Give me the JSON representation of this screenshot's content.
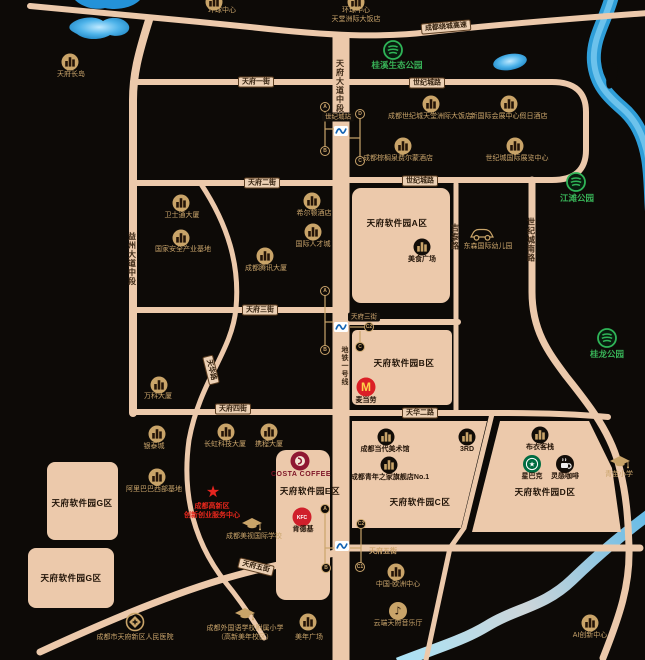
{
  "title": "天府软件园区域地图",
  "colors": {
    "background": "#0d0a07",
    "road": "#ecc9ab",
    "road_text": "#3a2715",
    "poi_text": "#c9a46b",
    "district_text": "#1f1206",
    "park_green": "#38b257",
    "alert_red": "#e6271c",
    "river_blue": "#2f9ed8",
    "metro_blue": "#1464b4",
    "mcdonalds_red": "#db1f26",
    "kfc_red": "#d01f2b",
    "costa_maroon": "#8f1732",
    "starbucks_green": "#006c41"
  },
  "districts": [
    {
      "name": "district-a",
      "label": "天府软件园A区",
      "x": 397,
      "y": 223
    },
    {
      "name": "district-b",
      "label": "天府软件园B区",
      "x": 404,
      "y": 363
    },
    {
      "name": "district-c",
      "label": "天府软件园C区",
      "x": 420,
      "y": 502
    },
    {
      "name": "district-d",
      "label": "天府软件园D区",
      "x": 545,
      "y": 492
    },
    {
      "name": "district-e",
      "label": "天府软件园E区",
      "x": 310,
      "y": 491
    },
    {
      "name": "district-g1",
      "label": "天府软件园G区",
      "x": 82,
      "y": 503
    },
    {
      "name": "district-g2",
      "label": "天府软件园G区",
      "x": 71,
      "y": 578
    }
  ],
  "road_labels": [
    {
      "label": "成都绕城高速",
      "x": 446,
      "y": 27,
      "kind": "plate",
      "rot": -5
    },
    {
      "label": "天府一街",
      "x": 256,
      "y": 82,
      "kind": "plate",
      "rot": 0
    },
    {
      "label": "世纪城路",
      "x": 427,
      "y": 83,
      "kind": "plate",
      "rot": 0
    },
    {
      "label": "天府二街",
      "x": 262,
      "y": 183,
      "kind": "plate",
      "rot": 0
    },
    {
      "label": "世纪城路",
      "x": 420,
      "y": 181,
      "kind": "plate",
      "rot": 0
    },
    {
      "label": "天府三街",
      "x": 260,
      "y": 310,
      "kind": "plate",
      "rot": 0
    },
    {
      "label": "天府三街",
      "x": 364,
      "y": 317,
      "kind": "darkplate",
      "rot": 0
    },
    {
      "label": "天府四街",
      "x": 233,
      "y": 409,
      "kind": "plate",
      "rot": 0
    },
    {
      "label": "天华二路",
      "x": 420,
      "y": 413,
      "kind": "plate",
      "rot": 0
    },
    {
      "label": "天府五街",
      "x": 383,
      "y": 551,
      "kind": "bare",
      "rot": 0
    },
    {
      "label": "天府五街",
      "x": 256,
      "y": 567,
      "kind": "plate",
      "rot": 14
    },
    {
      "label": "天华路",
      "x": 211,
      "y": 370,
      "kind": "plate",
      "rot": 76
    },
    {
      "label": "天府大道中段",
      "x": 340,
      "y": 86,
      "kind": "vroad",
      "rot": 0
    },
    {
      "label": "益州大道中段",
      "x": 132,
      "y": 259,
      "kind": "vroad",
      "rot": 0
    },
    {
      "label": "世纪城南路",
      "x": 531,
      "y": 240,
      "kind": "vroad",
      "rot": 0
    },
    {
      "label": "吉泰路",
      "x": 455,
      "y": 237,
      "kind": "vroad",
      "rot": 0
    }
  ],
  "metro": {
    "line_label": {
      "label": "地铁一号线",
      "x": 344,
      "y": 366
    },
    "stations": [
      {
        "name": "世纪城站",
        "plate": {
          "x": 338,
          "y": 117
        },
        "logo": {
          "x": 341,
          "y": 131
        },
        "exits": [
          {
            "letter": "A",
            "x": 325,
            "y": 107
          },
          {
            "letter": "D",
            "x": 360,
            "y": 114
          },
          {
            "letter": "B",
            "x": 325,
            "y": 151
          },
          {
            "letter": "C",
            "x": 360,
            "y": 161
          }
        ],
        "stems": [
          [
            [
              325,
              111
            ],
            [
              325,
              147
            ]
          ],
          [
            [
              325,
              129
            ],
            [
              334,
              129
            ]
          ],
          [
            [
              360,
              118
            ],
            [
              360,
              157
            ]
          ],
          [
            [
              360,
              138
            ],
            [
              349,
              138
            ]
          ]
        ]
      },
      {
        "name": "",
        "plate": null,
        "logo": {
          "x": 341,
          "y": 327
        },
        "exits": [
          {
            "letter": "A",
            "x": 325,
            "y": 291
          },
          {
            "letter": "C2",
            "x": 369,
            "y": 327
          },
          {
            "letter": "B",
            "x": 325,
            "y": 350
          },
          {
            "letter": "C",
            "x": 360,
            "y": 347
          }
        ],
        "stems": [
          [
            [
              325,
              295
            ],
            [
              325,
              346
            ]
          ],
          [
            [
              325,
              322
            ],
            [
              333,
              322
            ]
          ],
          [
            [
              364,
              327
            ],
            [
              350,
              327
            ]
          ],
          [
            [
              360,
              343
            ],
            [
              360,
              331
            ]
          ]
        ]
      },
      {
        "name": "",
        "plate": null,
        "logo": {
          "x": 342,
          "y": 546
        },
        "exits": [
          {
            "letter": "A",
            "x": 325,
            "y": 509
          },
          {
            "letter": "C2",
            "x": 361,
            "y": 524
          },
          {
            "letter": "B",
            "x": 326,
            "y": 568
          },
          {
            "letter": "C1",
            "x": 360,
            "y": 567
          }
        ],
        "stems": [
          [
            [
              325,
              513
            ],
            [
              325,
              564
            ]
          ],
          [
            [
              325,
              548
            ],
            [
              334,
              548
            ]
          ],
          [
            [
              361,
              528
            ],
            [
              361,
              563
            ]
          ],
          [
            [
              361,
              548
            ],
            [
              350,
              548
            ]
          ]
        ]
      }
    ]
  },
  "pois": [
    {
      "name": "huanqiu-center",
      "type": "building",
      "x": 214,
      "y": 2,
      "lx": 222,
      "ly": 7,
      "lines": [
        "环球中心"
      ],
      "style": ""
    },
    {
      "name": "huanqiu-intercontinental-hotel",
      "type": "building",
      "x": 356,
      "y": 2,
      "lx": 356,
      "ly": 7,
      "lines": [
        "环球中心",
        "天堂洲际大饭店"
      ],
      "style": ""
    },
    {
      "name": "tianfu-changdao",
      "type": "building",
      "x": 70,
      "y": 62,
      "lx": 71,
      "ly": 71,
      "lines": [
        "天府长岛"
      ],
      "style": ""
    },
    {
      "name": "century-city-intercontinental",
      "type": "building",
      "x": 431,
      "y": 104,
      "lx": 430,
      "ly": 113,
      "lines": [
        "成都世纪城天堂洲际大饭店"
      ],
      "style": ""
    },
    {
      "name": "holiday-inn-new-convention",
      "type": "building",
      "x": 509,
      "y": 104,
      "lx": 509,
      "ly": 113,
      "lines": [
        "新国际会展中心假日酒店"
      ],
      "style": ""
    },
    {
      "name": "fairmont-hotel",
      "type": "building",
      "x": 403,
      "y": 146,
      "lx": 398,
      "ly": 155,
      "lines": [
        "成都棕榈泉费尔蒙酒店"
      ],
      "style": ""
    },
    {
      "name": "century-city-exhibition-center",
      "type": "building",
      "x": 515,
      "y": 146,
      "lx": 517,
      "ly": 155,
      "lines": [
        "世纪城国际展览中心"
      ],
      "style": ""
    },
    {
      "name": "weishitong-tower",
      "type": "building",
      "x": 181,
      "y": 203,
      "lx": 182,
      "ly": 212,
      "lines": [
        "卫士通大厦"
      ],
      "style": ""
    },
    {
      "name": "national-security-industry-base",
      "type": "building",
      "x": 181,
      "y": 238,
      "lx": 183,
      "ly": 246,
      "lines": [
        "国家安全产业基地"
      ],
      "style": ""
    },
    {
      "name": "tencent-tower",
      "type": "building",
      "x": 265,
      "y": 256,
      "lx": 266,
      "ly": 265,
      "lines": [
        "成都腾讯大厦"
      ],
      "style": ""
    },
    {
      "name": "hilton-hotel",
      "type": "building",
      "x": 312,
      "y": 201,
      "lx": 314,
      "ly": 210,
      "lines": [
        "希尔顿酒店"
      ],
      "style": ""
    },
    {
      "name": "international-talent-city",
      "type": "building",
      "x": 313,
      "y": 232,
      "lx": 313,
      "ly": 241,
      "lines": [
        "国际人才城"
      ],
      "style": ""
    },
    {
      "name": "vanke-tower",
      "type": "building",
      "x": 159,
      "y": 385,
      "lx": 158,
      "ly": 393,
      "lines": [
        "万科大厦"
      ],
      "style": ""
    },
    {
      "name": "yintai-city",
      "type": "building",
      "x": 157,
      "y": 434,
      "lx": 154,
      "ly": 443,
      "lines": [
        "银泰城"
      ],
      "style": ""
    },
    {
      "name": "changhong-tech-tower",
      "type": "building",
      "x": 226,
      "y": 432,
      "lx": 225,
      "ly": 441,
      "lines": [
        "长虹科技大厦"
      ],
      "style": ""
    },
    {
      "name": "ctrip-tower",
      "type": "building",
      "x": 269,
      "y": 432,
      "lx": 269,
      "ly": 441,
      "lines": [
        "携程大厦"
      ],
      "style": ""
    },
    {
      "name": "alibaba-west-base",
      "type": "building",
      "x": 157,
      "y": 477,
      "lx": 154,
      "ly": 486,
      "lines": [
        "阿里巴巴西部基地"
      ],
      "style": ""
    },
    {
      "name": "contemporary-art-museum",
      "type": "building-dark",
      "x": 386,
      "y": 437,
      "lx": 385,
      "ly": 446,
      "lines": [
        "成都当代美术馆"
      ],
      "style": "dark"
    },
    {
      "name": "jrd",
      "type": "building-dark",
      "x": 467,
      "y": 437,
      "lx": 467,
      "ly": 446,
      "lines": [
        "3RD"
      ],
      "style": "dark"
    },
    {
      "name": "youth-home-flagship",
      "type": "building-dark",
      "x": 389,
      "y": 465,
      "lx": 390,
      "ly": 474,
      "lines": [
        "成都青年之家旗舰店No.1"
      ],
      "style": "dark"
    },
    {
      "name": "buyi-inn",
      "type": "building-dark",
      "x": 540,
      "y": 435,
      "lx": 540,
      "ly": 444,
      "lines": [
        "布衣客栈"
      ],
      "style": "dark"
    },
    {
      "name": "starbucks",
      "type": "starbucks",
      "x": 532,
      "y": 464,
      "lx": 532,
      "ly": 473,
      "lines": [
        "星巴克"
      ],
      "style": "dark"
    },
    {
      "name": "linggan-coffee",
      "type": "coffee",
      "x": 565,
      "y": 464,
      "lx": 565,
      "ly": 473,
      "lines": [
        "灵感咖啡"
      ],
      "style": "dark"
    },
    {
      "name": "food-plaza",
      "type": "building-dark",
      "x": 422,
      "y": 247,
      "lx": 422,
      "ly": 256,
      "lines": [
        "美食广场"
      ],
      "style": "dark"
    },
    {
      "name": "mcdonalds",
      "type": "mcd",
      "x": 366,
      "y": 387,
      "lx": 366,
      "ly": 397,
      "lines": [
        "麦当劳"
      ],
      "style": "dark"
    },
    {
      "name": "kfc",
      "type": "kfc",
      "x": 302,
      "y": 517,
      "lx": 303,
      "ly": 526,
      "lines": [
        "肯德基"
      ],
      "style": "dark"
    },
    {
      "name": "costa-coffee",
      "type": "costa",
      "x": 300,
      "y": 461,
      "lx": 301,
      "ly": 471,
      "lines": [
        "COSTA COFFEE"
      ],
      "style": "costa"
    },
    {
      "name": "dongsen-kindergarten",
      "type": "car",
      "x": 482,
      "y": 234,
      "lx": 488,
      "ly": 243,
      "lines": [
        "东森国际幼儿园"
      ],
      "style": ""
    },
    {
      "name": "meishi-international-school",
      "type": "school",
      "x": 252,
      "y": 524,
      "lx": 254,
      "ly": 533,
      "lines": [
        "成都美视国际学校"
      ],
      "style": ""
    },
    {
      "name": "foreign-language-primary-school",
      "type": "school",
      "x": 245,
      "y": 614,
      "lx": 245,
      "ly": 625,
      "lines": [
        "成都外国语学校附属小学",
        "（高新美年校区）"
      ],
      "style": ""
    },
    {
      "name": "qingmiao-primary-school",
      "type": "school",
      "x": 620,
      "y": 462,
      "lx": 619,
      "ly": 471,
      "lines": [
        "青苗小学"
      ],
      "style": ""
    },
    {
      "name": "china-europe-center",
      "type": "building",
      "x": 396,
      "y": 572,
      "lx": 398,
      "ly": 581,
      "lines": [
        "中国-欧洲中心"
      ],
      "style": ""
    },
    {
      "name": "yunduan-tianfu-music-hall",
      "type": "music",
      "x": 398,
      "y": 611,
      "lx": 398,
      "ly": 620,
      "lines": [
        "云端天府音乐厅"
      ],
      "style": ""
    },
    {
      "name": "ai-innovation-center",
      "type": "building",
      "x": 590,
      "y": 623,
      "lx": 590,
      "ly": 632,
      "lines": [
        "AI创新中心"
      ],
      "style": ""
    },
    {
      "name": "meinian-plaza",
      "type": "building",
      "x": 308,
      "y": 622,
      "lx": 309,
      "ly": 634,
      "lines": [
        "美年广场"
      ],
      "style": ""
    },
    {
      "name": "tianfu-new-district-peoples-hospital",
      "type": "hospital",
      "x": 135,
      "y": 622,
      "lx": 135,
      "ly": 634,
      "lines": [
        "成都市天府新区人民医院"
      ],
      "style": ""
    }
  ],
  "parks": [
    {
      "name": "guixi-eco-park",
      "label": "桂溪生态公园",
      "x": 393,
      "y": 50,
      "lx": 397,
      "ly": 59
    },
    {
      "name": "jiangtan-park",
      "label": "江滩公园",
      "x": 576,
      "y": 182,
      "lx": 577,
      "ly": 192
    },
    {
      "name": "guilong-park",
      "label": "桂龙公园",
      "x": 607,
      "y": 338,
      "lx": 607,
      "ly": 348
    }
  ],
  "note": {
    "star": {
      "x": 213,
      "y": 493
    },
    "x": 212,
    "y": 502,
    "lines": [
      "成都高新区",
      "创新创业服务中心"
    ]
  }
}
